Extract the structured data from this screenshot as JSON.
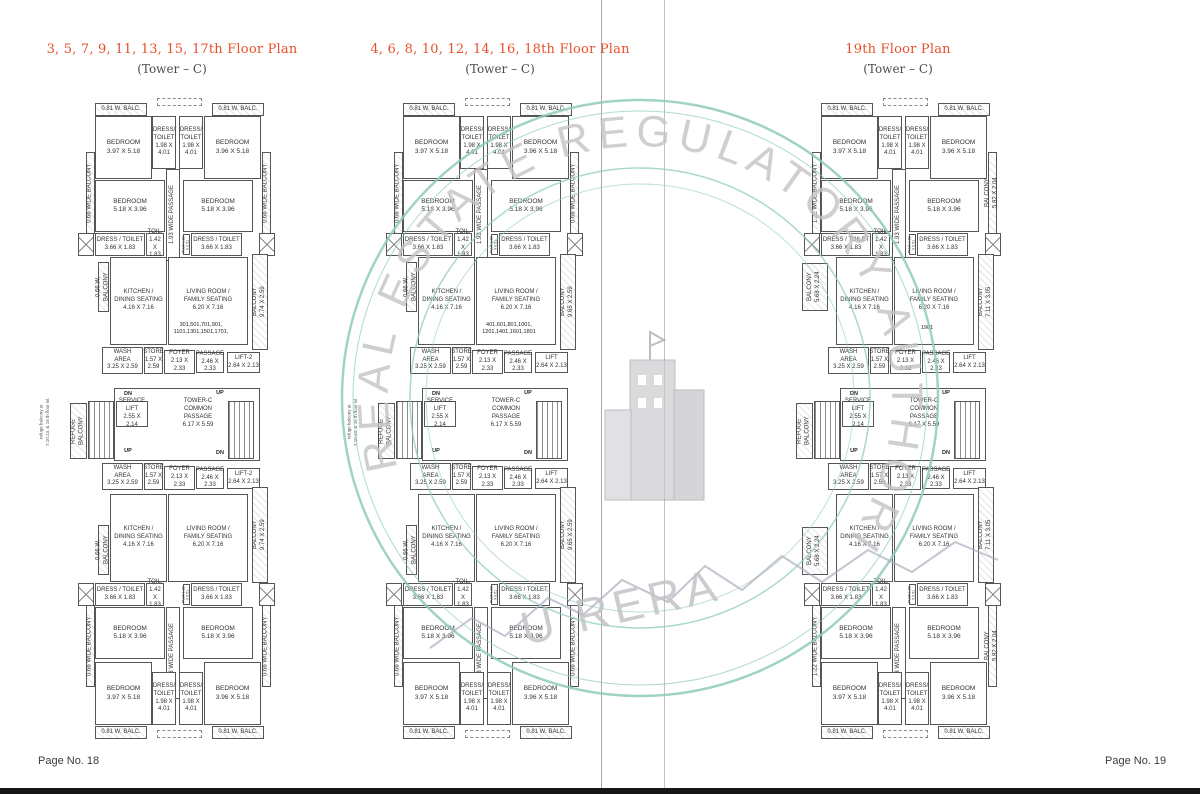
{
  "page": {
    "footer_left": "Page No. 18",
    "footer_right": "Page No. 19",
    "accent_color": "#e8502a"
  },
  "watermark": {
    "arc_text": "REAL ESTATE REGULATORY AUTHORITY",
    "bottom_text": "U RERA",
    "ring_color": "#8fcbbb",
    "text_color": "#c4c4c6"
  },
  "plans": [
    {
      "title": "3, 5, 7, 9, 11, 13, 15, 17th Floor Plan",
      "subtitle": "(Tower – C)",
      "labels": {
        "wbalc": "0.81 W. BALC.",
        "bedroom_a": "BEDROOM\n3.97 X 5.18",
        "bedroom_b": "BEDROOM\n3.96 X 5.18",
        "dress_small": "DRESS/\nTOILET\n1.98 X\n4.01",
        "side_balcony_left": "0.66 WIDE BALCONY",
        "side_balcony_right": "0.66 WIDE BALCONY",
        "bedroom_mid": "BEDROOM\n5.18 X 3.96",
        "passage_wide": "1.93 WIDE PASSAGE",
        "dress_toilet": "DRESS / TOILET\n3.66 X 1.83",
        "toil": "TOIL.\n1.42 X\n1.83",
        "puja": "PUJA 1.83 X 0.51",
        "kitchen_balcony": "0.66 W. BALCONY",
        "kitchen": "KITCHEN /\nDINING SEATING\n4.16 X 7.16",
        "living": "LIVING ROOM /\nFAMILY SEATING\n6.20 X 7.16",
        "units_upper": "301,501,701,901,\n1101,1301,1501,1701,",
        "units_lower": "302,502,702,902,\n1102,1302,1502,1702,",
        "balcony_right": "BALCONY\n9.74 X 2.59",
        "wash": "WASH\nAREA\n3.25 X 2.59",
        "store": "STORE\n1.57 X\n2.59",
        "foyer": "FOYER\n2.13 X 2.33",
        "passage": "PASSAGE\n2.46 X 2.33",
        "lift": "LIFT-2\n2.64 X 2.13",
        "refuge": "REFUGE\nBALCONY",
        "service_lift": "SERVICE\nLIFT\n2.55 X 2.14",
        "common_passage": "TOWER-C\nCOMMON\nPASSAGE\n6.17 X 5.59",
        "dn": "DN",
        "up": "UP",
        "refuge_note": "refuge balcony at\n7,10,13, & 16 th floor lvl."
      }
    },
    {
      "title": "4, 6, 8, 10, 12, 14, 16, 18th Floor Plan",
      "subtitle": "(Tower – C)",
      "labels": {
        "wbalc": "0.81 W. BALC.",
        "bedroom_a": "BEDROOM\n3.97 X 5.18",
        "bedroom_b": "BEDROOM\n3.96 X 5.18",
        "dress_small": "DRESS/\nTOILET\n1.98 X\n4.01",
        "side_balcony_left": "0.66 WIDE BALCONY",
        "side_balcony_right": "0.66 WIDE BALCONY",
        "bedroom_mid": "BEDROOM\n5.18 X 3.96",
        "passage_wide": "1.93 WIDE PASSAGE",
        "dress_toilet": "DRESS / TOILET\n3.66 X 1.83",
        "toil": "TOIL.\n1.42 X\n1.83",
        "puja": "PUJA 1.83 X 0.51",
        "kitchen_balcony": "0.66 W. BALCONY",
        "kitchen": "KITCHEN /\nDINING SEATING\n4.16 X 7.16",
        "living": "LIVING ROOM /\nFAMILY SEATING\n6.20 X 7.16",
        "units_upper": "401,601,801,1001,\n1201,1401,1601,1801",
        "units_lower": "402,602,802,1002,\n1202,1402,1602,1802",
        "balcony_right": "BALCONY\n9.65 X 2.59",
        "wash": "WASH\nAREA\n3.25 X 2.59",
        "store": "STORE\n1.57 X\n2.59",
        "foyer": "FOYER\n2.13 X 2.33",
        "passage": "PASSAGE\n2.46 X 2.33",
        "lift": "LIFT\n2.64 X 2.13",
        "refuge": "REFUGE\nBALCONY",
        "service_lift": "SERVICE\nLIFT\n2.55 X 2.14",
        "common_passage": "TOWER-C\nCOMMON\nPASSAGE\n6.17 X 5.59",
        "dn": "DN",
        "up": "UP",
        "refuge_note": "refuge balcony at\n7,10,13, & 16 th floor lvl."
      }
    },
    {
      "title": "19th Floor Plan",
      "subtitle": "(Tower – C)",
      "labels": {
        "wbalc": "0.81 W. BALC.",
        "bedroom_a": "BEDROOM\n3.97 X 5.18",
        "bedroom_b": "BEDROOM\n3.96 X 5.18",
        "dress_small": "DRESS/\nTOILET\n1.98 X\n4.01",
        "side_balcony_left": "1.22 WIDE BALCONY",
        "side_balcony_right": "BALCONY\n5.92 X 2.04",
        "bedroom_mid": "BEDROOM\n5.18 X 3.96",
        "passage_wide": "1.93 WIDE PASSAGE",
        "dress_toilet": "DRESS / TOILET\n3.66 X 1.83",
        "toil": "TOIL.\n1.42 X\n1.83",
        "puja": "PUJA 1.83 X 0.51",
        "balcony_568": "BALCONY\n5.68 X 2.24",
        "kitchen": "KITCHEN /\nDINING SEATING\n4.16 X 7.16",
        "living": "LIVING ROOM /\nFAMILY SEATING\n6.20 X 7.16",
        "units_upper": "1901",
        "units_lower": "1902",
        "balcony_right": "BALCONY\n7.11 X 3.05",
        "wash": "WASH\nAREA\n3.25 X 2.59",
        "store": "STORE\n1.57 X\n2.59",
        "foyer": "FOYER\n2.13 X 2.33",
        "passage": "PASSAGE\n2.46 X 2.33",
        "lift": "LIFT\n2.64 X 2.13",
        "refuge": "REFUGE\nBALCONY",
        "service_lift": "SERVICE\nLIFT\n2.55 X 2.14",
        "common_passage": "TOWER-C\nCOMMON\nPASSAGE\n6.17 X 5.59",
        "dn": "DN",
        "up": "UP"
      }
    }
  ]
}
